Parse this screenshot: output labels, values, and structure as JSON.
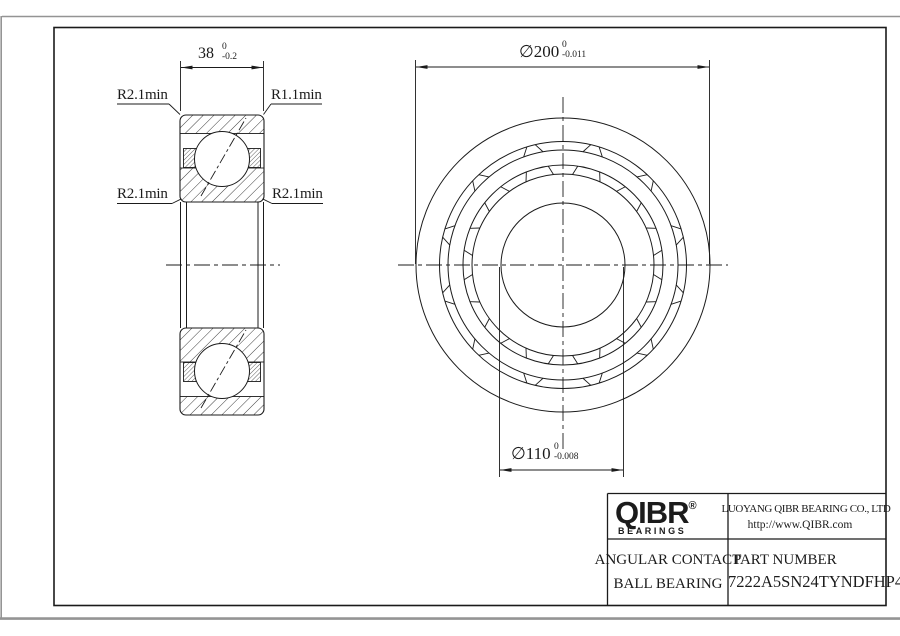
{
  "drawing": {
    "dim_width": {
      "value": "38",
      "tol_upper": "0",
      "tol_lower": "-0.2"
    },
    "dim_od": {
      "value": "∅200",
      "tol_upper": "0",
      "tol_lower": "-0.011"
    },
    "dim_bore": {
      "value": "∅110",
      "tol_upper": "0",
      "tol_lower": "-0.008"
    },
    "radius_labels": {
      "top_left": "R2.1min",
      "top_right": "R1.1min",
      "mid_left": "R2.1min",
      "mid_right": "R2.1min"
    }
  },
  "title_block": {
    "logo_text": "QIBR",
    "logo_registered": "®",
    "logo_sub": "BEARINGS",
    "company": "LUOYANG QIBR BEARING CO., LTD",
    "website": "http://www.QIBR.com",
    "product_line1": "ANGULAR CONTACT",
    "product_line2": "BALL BEARING",
    "part_number_label": "PART NUMBER",
    "part_number": "7222A5SN24TYNDFHP4"
  },
  "colors": {
    "line": "#1b1b1b",
    "page_edge": "#949494"
  }
}
